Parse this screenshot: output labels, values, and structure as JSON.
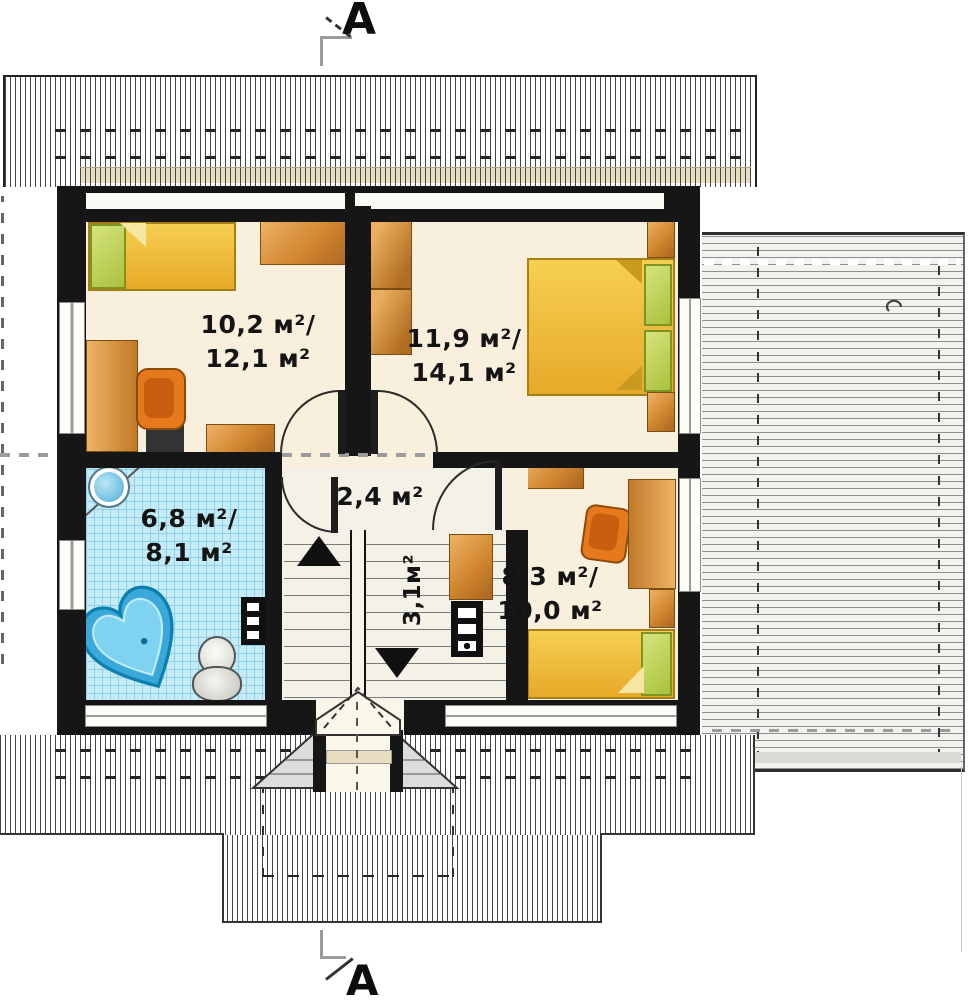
{
  "drawing": {
    "type": "attic floor plan",
    "section_marker_top": "A",
    "section_marker_bottom": "A"
  },
  "rooms": [
    {
      "name": "bedroom-top-left",
      "area_line1": "10,2 м²/",
      "area_line2": "12,1 м²"
    },
    {
      "name": "bedroom-top-right",
      "area_line1": "11,9 м²/",
      "area_line2": "14,1 м²"
    },
    {
      "name": "bathroom",
      "area_line1": "6,8 м²/",
      "area_line2": "8,1 м²"
    },
    {
      "name": "hallway",
      "area_line1": "2,4 м²"
    },
    {
      "name": "bedroom-bottom-right",
      "area_line1": "8,3 м²/",
      "area_line2": "10,0 м²"
    },
    {
      "name": "staircase",
      "area_line1": "3,1м²"
    }
  ],
  "furniture": [
    "single-bed",
    "double-bed",
    "wardrobe",
    "desk",
    "office-chair",
    "shelf",
    "nightstand",
    "cabinet",
    "heart-bathtub",
    "toilet",
    "washbasin",
    "radiator",
    "stairs-up-arrow",
    "stairs-down-arrow"
  ],
  "colors": {
    "wall": "#161616",
    "floor": "#f8efdc",
    "bathroom_tile": "#c6ebf8",
    "furniture_orange": "#d1862f",
    "bed_yellow": "#f0c23c",
    "pillow_green": "#bfd45e",
    "tub_blue": "#3aa9da",
    "roof_hatch": "#474747"
  }
}
